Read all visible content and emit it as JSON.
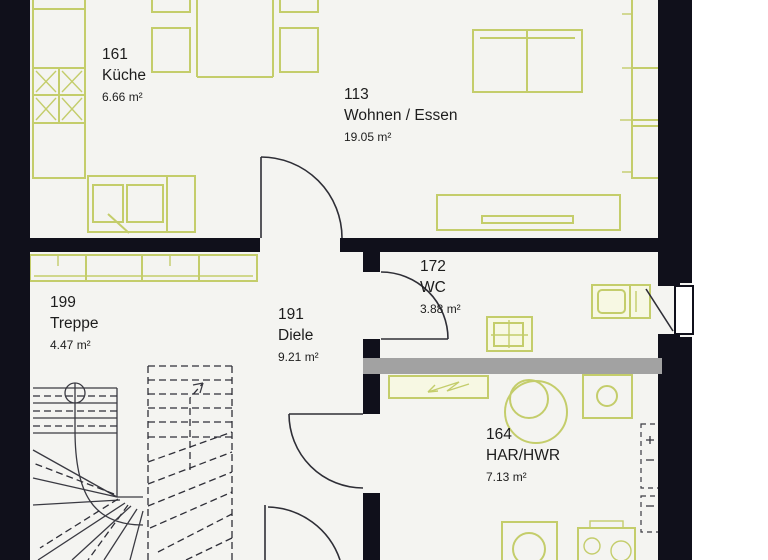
{
  "plan": {
    "rooms": [
      {
        "id": "kueche",
        "number": "161",
        "name": "Küche",
        "area": "6.66 m²"
      },
      {
        "id": "wohnen-essen",
        "number": "113",
        "name": "Wohnen / Essen",
        "area": "19.05 m²"
      },
      {
        "id": "treppe",
        "number": "199",
        "name": "Treppe",
        "area": "4.47 m²"
      },
      {
        "id": "diele",
        "number": "191",
        "name": "Diele",
        "area": "9.21 m²"
      },
      {
        "id": "wc",
        "number": "172",
        "name": "WC",
        "area": "3.88 m²"
      },
      {
        "id": "har-hwr",
        "number": "164",
        "name": "HAR/HWR",
        "area": "7.13 m²"
      }
    ],
    "fixtures": [
      "kitchen-counter",
      "hob",
      "kitchen-sink",
      "dining-table",
      "dining-chairs",
      "sofa",
      "wall-couch",
      "sideboard",
      "wardrobe",
      "winder-stairs",
      "upper-flight-dashed",
      "washbasin",
      "toilet",
      "entrance-door",
      "interior-doors",
      "electrical-panel",
      "boiler",
      "washing-machine",
      "dryer",
      "service-shaft"
    ]
  },
  "colors": {
    "wall": "#10101b",
    "floor": "#f4f4f1",
    "outside": "#ffffff",
    "fixture": "#c4cd6b",
    "fixturefill": "#f7f8e3",
    "graywall": "#a2a2a2",
    "line": "#2e2e36",
    "text": "#1d1d1d"
  }
}
